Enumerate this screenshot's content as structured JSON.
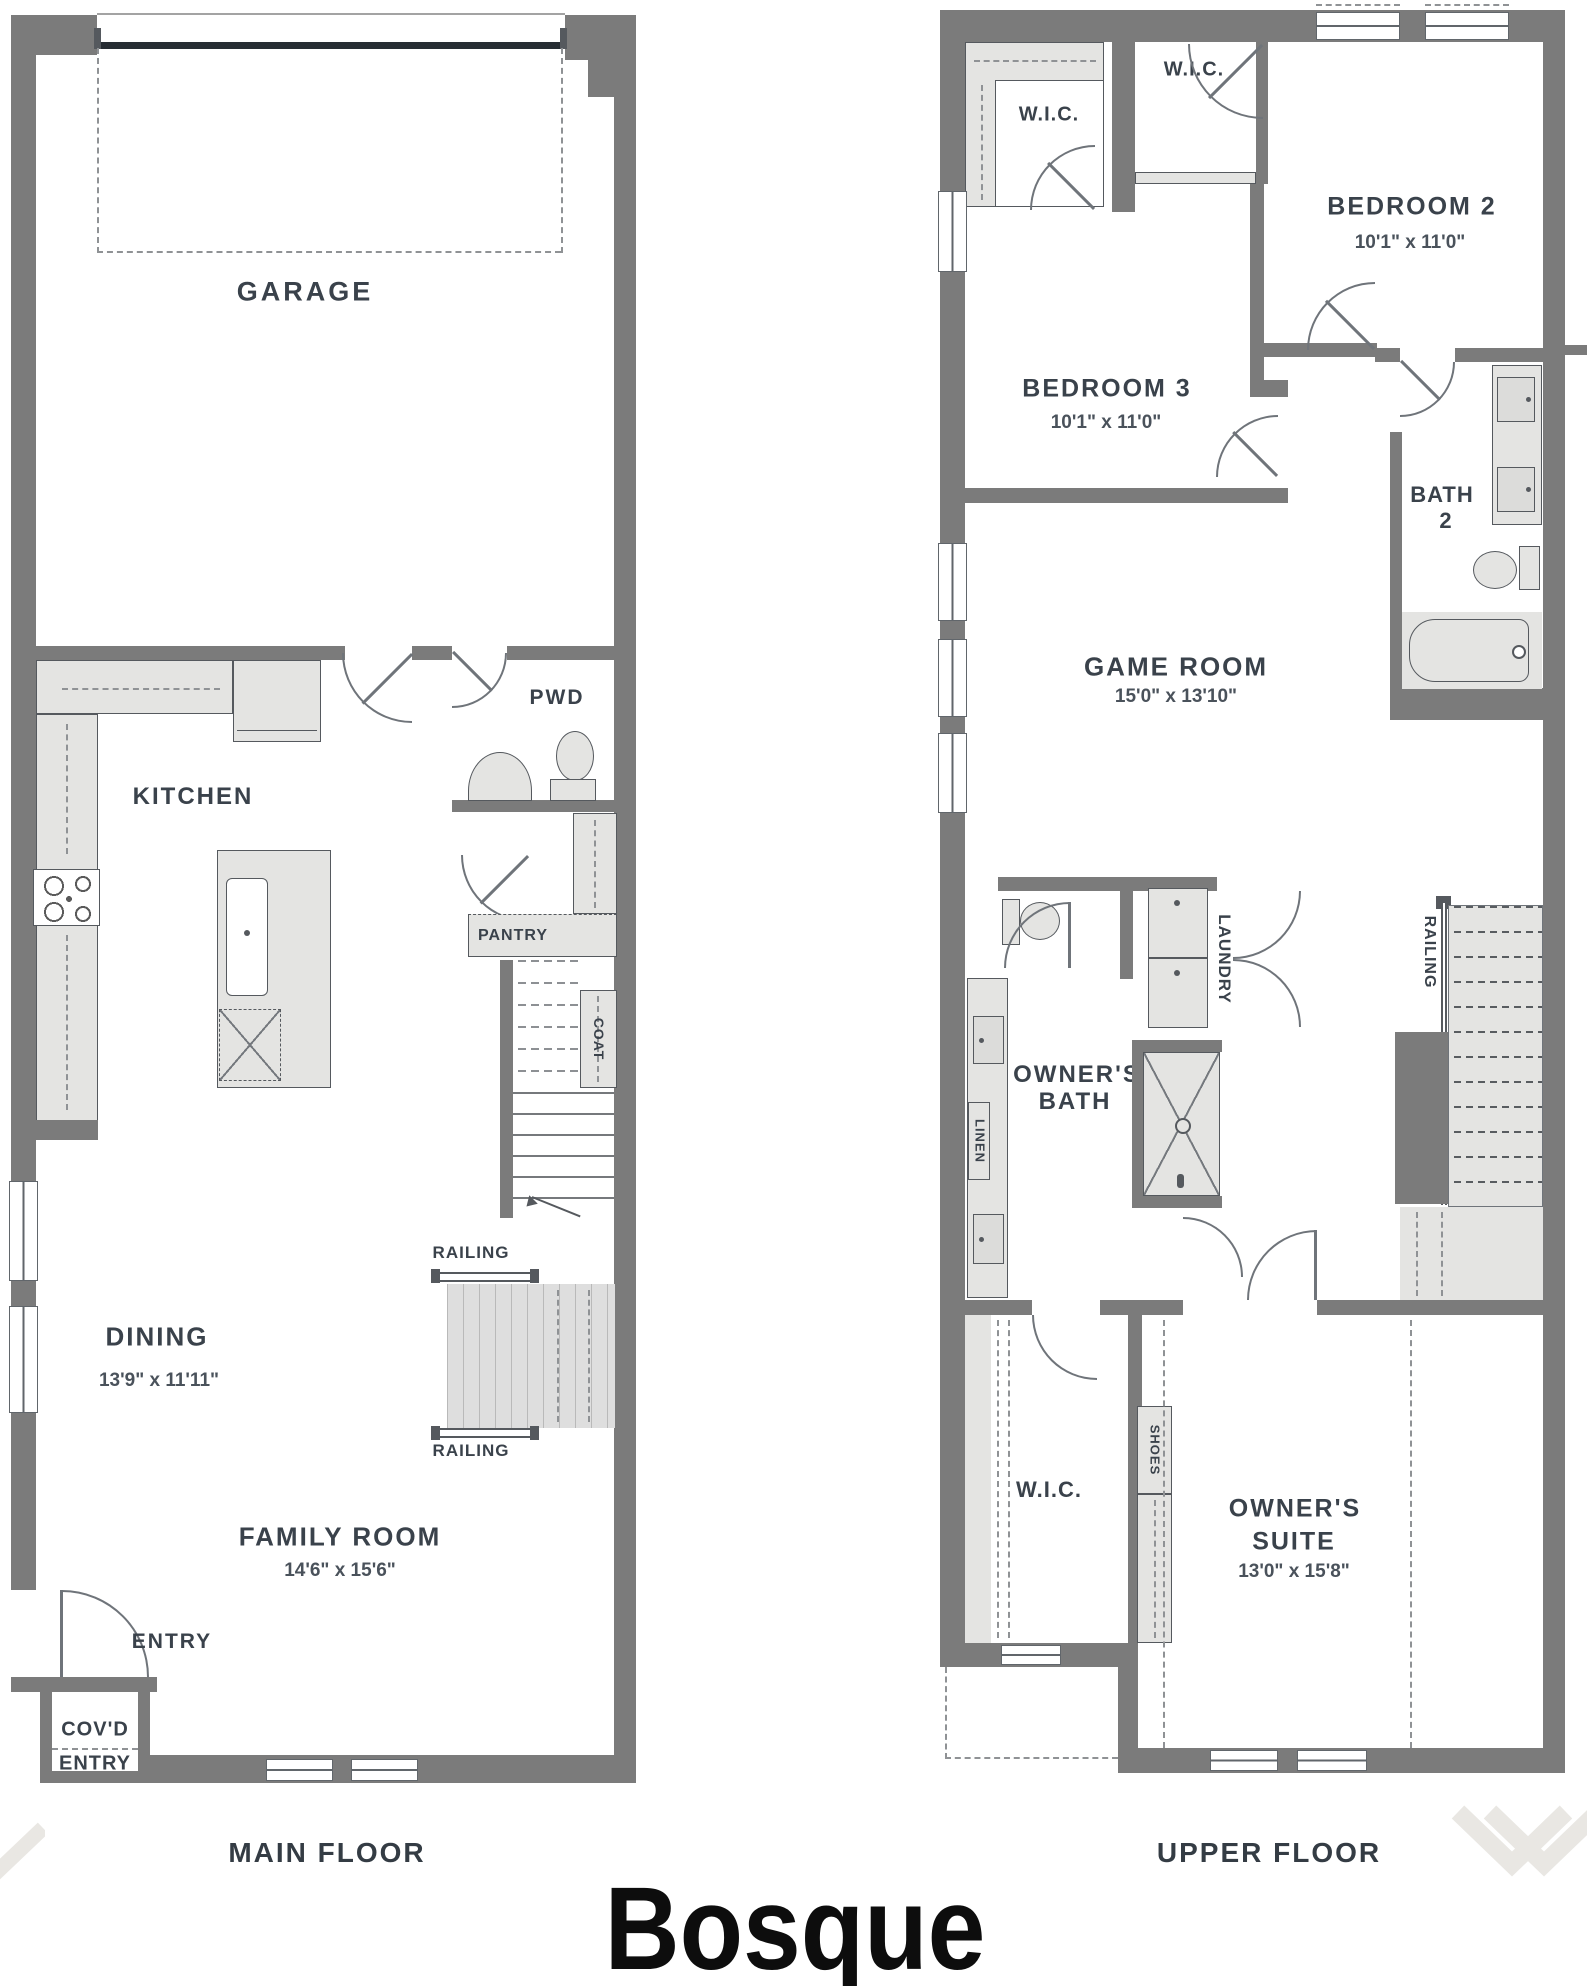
{
  "title": "Bosque",
  "floor_captions": {
    "main": "MAIN FLOOR",
    "upper": "UPPER FLOOR"
  },
  "main_floor": {
    "garage": "GARAGE",
    "kitchen": "KITCHEN",
    "pwd": "PWD",
    "pantry": "PANTRY",
    "coat": "COAT",
    "railing_top": "RAILING",
    "railing_bottom": "RAILING",
    "dining": {
      "label": "DINING",
      "dims": "13'9\" x 11'11\""
    },
    "family_room": {
      "label": "FAMILY ROOM",
      "dims": "14'6\" x 15'6\""
    },
    "entry": "ENTRY",
    "covd_entry": {
      "line1": "COV'D",
      "line2": "ENTRY"
    }
  },
  "upper_floor": {
    "wic_bedroom3": "W.I.C.",
    "wic_bedroom2": "W.I.C.",
    "bedroom2": {
      "label": "BEDROOM 2",
      "dims": "10'1\" x 11'0\""
    },
    "bedroom3": {
      "label": "BEDROOM 3",
      "dims": "10'1\" x 11'0\""
    },
    "bath2": {
      "line1": "BATH",
      "line2": "2"
    },
    "game_room": {
      "label": "GAME ROOM",
      "dims": "15'0\" x 13'10\""
    },
    "laundry": "LAUNDRY",
    "railing": "RAILING",
    "owners_bath": {
      "line1": "OWNER'S",
      "line2": "BATH"
    },
    "linen": "LINEN",
    "shoes": "SHOES",
    "wic_owners": "W.I.C.",
    "owners_suite": {
      "line1": "OWNER'S",
      "line2": "SUITE",
      "dims": "13'0\" x 15'8\""
    }
  },
  "colors": {
    "wall": "#7b7b7b",
    "fixture_fill": "#e4e4e2",
    "label_text": "#3a424b",
    "garage_door": "#272d33",
    "title_text": "#0d0d0d",
    "watermark": "#e9e7e3"
  }
}
